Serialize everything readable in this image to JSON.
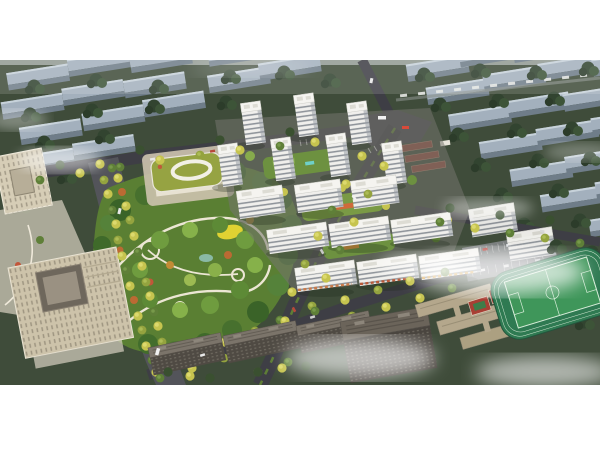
{
  "scene": {
    "title": "Aerial rendering of a residential master plan",
    "description": "Bird's-eye architectural rendering: a gated community of white residential towers and slab apartment blocks around landscaped podium courtyards, a large organic central park with winding white paths and a yellow playground, a green-roofed kindergarten, tree-lined boulevards with autumn-yellow street trees, a beige civic office complex at the lower left, dark high-rise slabs in the foreground, and a school sports ground with a green pitch, running track and red courts at the lower right. The surrounding city is shown as muted grey slab blocks in dark tree canopy under drifting white clouds.",
    "regions": {
      "surrounding_city": "Surrounding city slab blocks in tree canopy",
      "background_trees": "Dense dark tree canopy",
      "clouds": "Drifting white clouds and haze",
      "north_road": "North boundary road",
      "east_avenue": "Tree-lined east avenue",
      "west_boulevard": "Wide tree-filled west boulevard",
      "south_road": "South boundary road with yellow street trees",
      "junction": "Main road junction with buses",
      "central_park": "Central landscaped park with winding paths",
      "kindergarten": "Kindergarten with olive-green roof and oval courtyard",
      "residential_cluster": "White residential towers and slab blocks",
      "courtyards": "Podium garden courtyards",
      "commercial_strip": "Street-level shopfronts",
      "red_roof_buildings": "Red-roofed low-rise buildings",
      "parking_lot": "Surface parking lot with cars",
      "office_tower": "Beige office tower",
      "civic_building": "Beige civic building with inner courtyard",
      "plaza": "Paved civic plaza with curved paths",
      "foreground_buildings": "Dark foreground apartment slabs",
      "school_buildings": "Beige school buildings",
      "sports_ground": "Sports ground with pitch, track and red courts",
      "vehicles": "Cars and buses on the roads"
    }
  },
  "palette": {
    "page_background": "#ffffff",
    "canopy_dark_green": "#3f4c3a",
    "city_slab_grey": "#a3b0bd",
    "road_asphalt": "#3e3e45",
    "park_green": "#5a7f33",
    "street_tree_yellow": "#c6c44f",
    "street_tree_green": "#5f7f38",
    "residential_white": "#f0efec",
    "window_band_grey": "#7f858d",
    "kindergarten_roof_olive": "#96a342",
    "civic_beige": "#cdc3aa",
    "foreground_slab_dark": "#4f4a43",
    "pitch_green": "#3f965a",
    "court_red": "#a83f34",
    "playground_yellow": "#e0d232",
    "cloud_white": "#ffffff"
  },
  "canvas": {
    "width": 600,
    "height": 450,
    "photo_top": 60,
    "photo_height": 325
  }
}
